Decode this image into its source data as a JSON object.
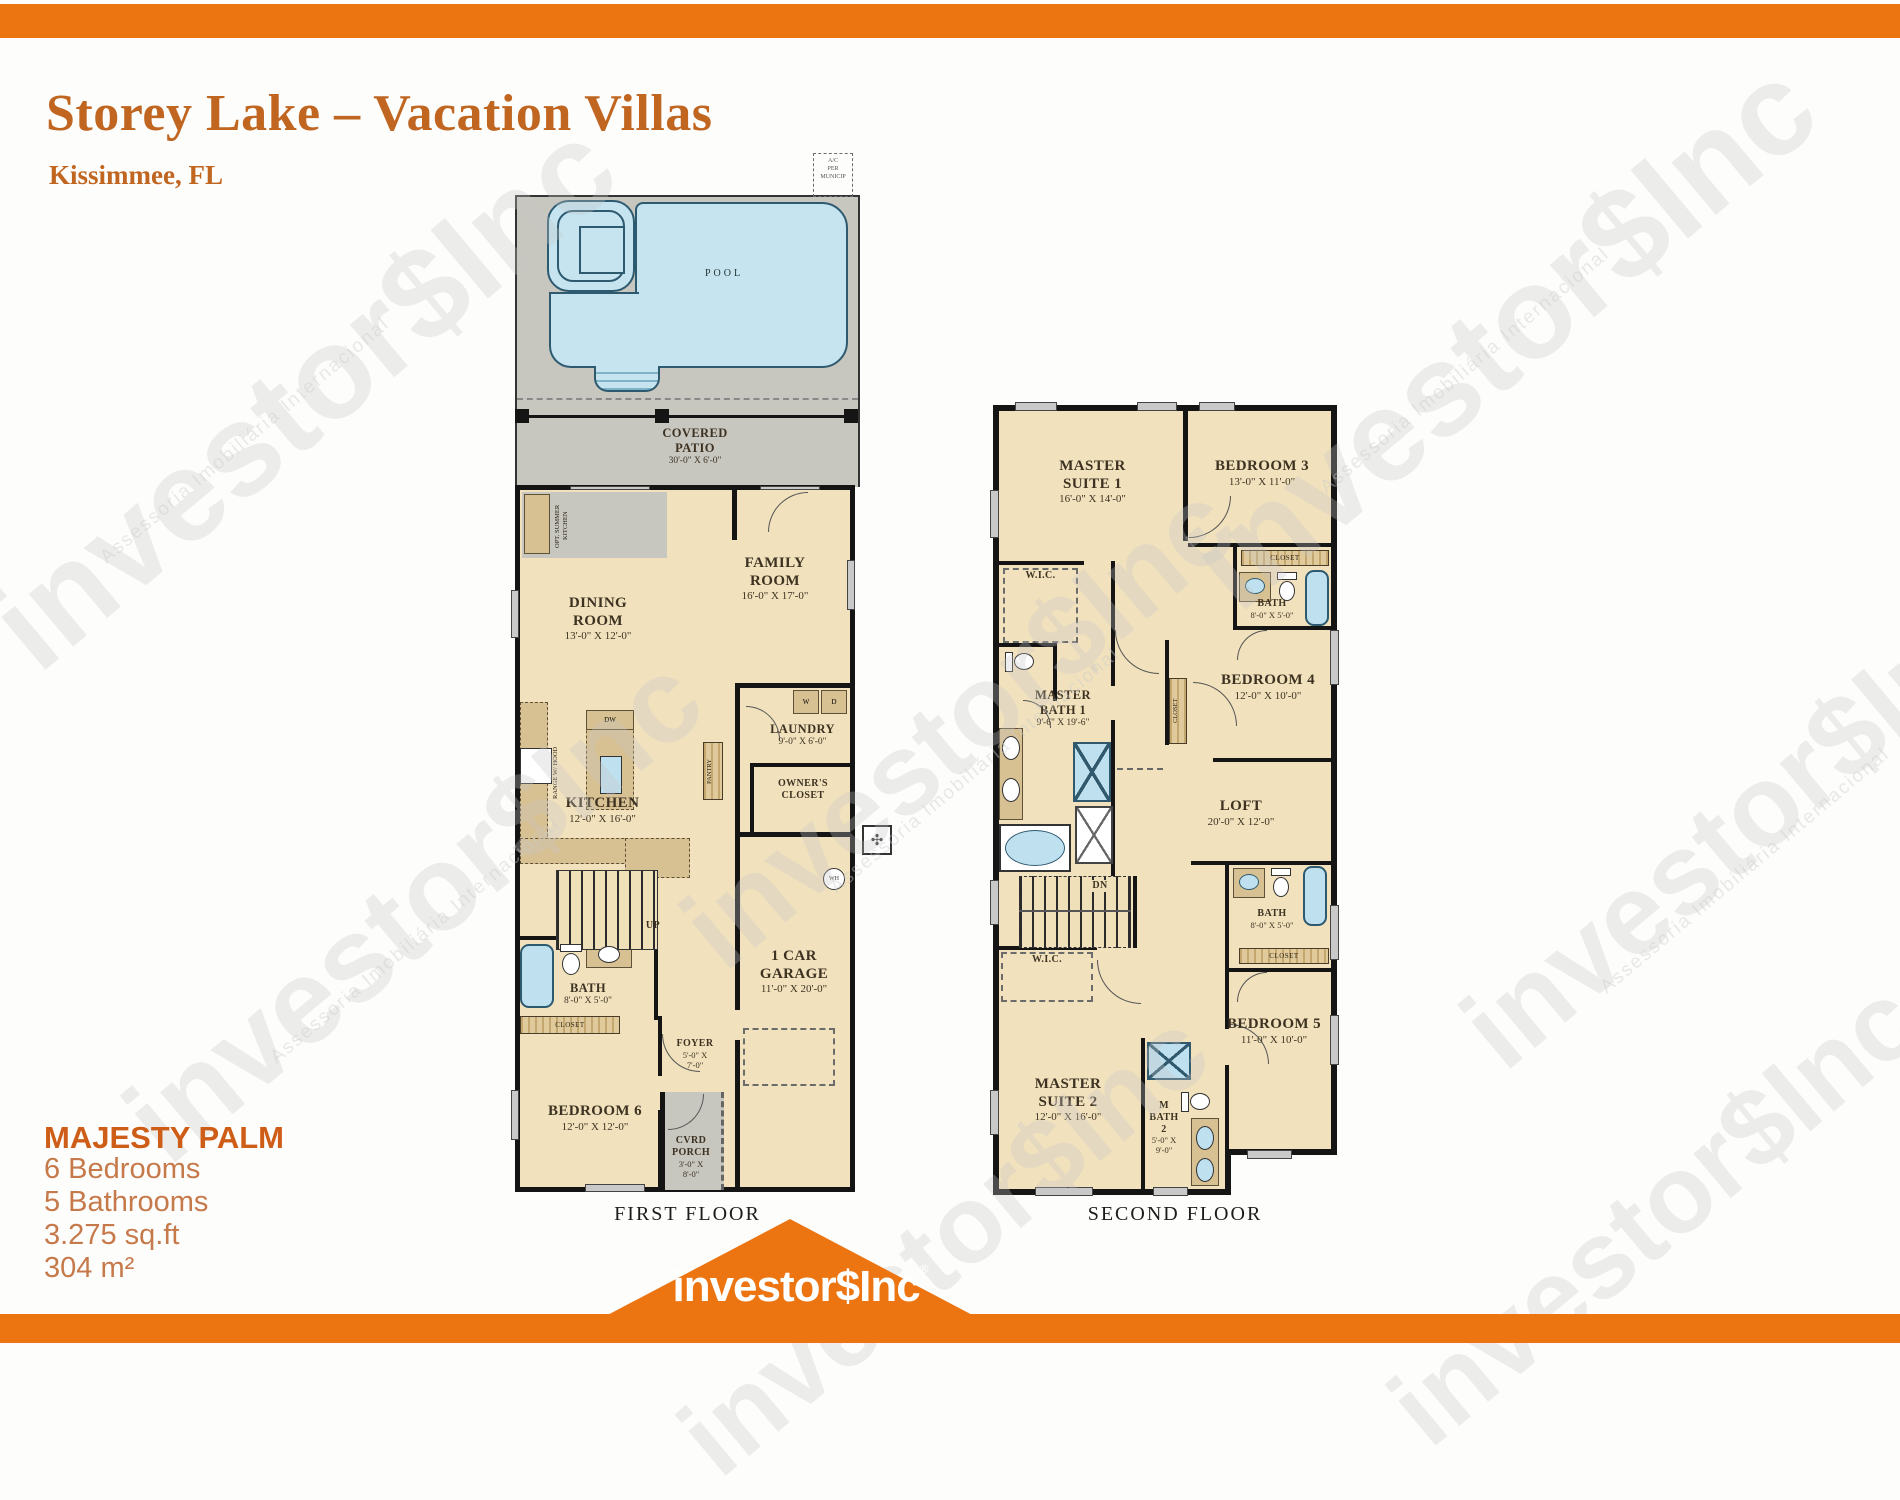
{
  "header": {
    "title": "Storey Lake – Vacation Villas",
    "subtitle": "Kissimmee, FL"
  },
  "property": {
    "name": "MAJESTY PALM",
    "bedrooms": "6 Bedrooms",
    "bathrooms": "5 Bathrooms",
    "area_imperial": "3.275 sq.ft",
    "area_metric": "304 m²"
  },
  "watermark": {
    "brand": "investor$Inc",
    "tagline": "Assessoria Imobiliária Internacional"
  },
  "footer": {
    "brand": "investor$Inc",
    "registered": "®"
  },
  "colors": {
    "accent_orange": "#EC7512",
    "title_orange": "#C06621",
    "info_orange": "#C67A4B",
    "room_beige": "#F1E2BD",
    "deck_gray": "#C7C6BF",
    "pool_blue": "#BFE0EE",
    "cabinet_tan": "#D7C092"
  },
  "floors": {
    "first": {
      "caption": "FIRST FLOOR",
      "outdoor": {
        "pool": "POOL",
        "equip_l1": "A/C",
        "equip_l2": "PER",
        "equip_l3": "MUNICIP",
        "patio_l1": "COVERED",
        "patio_l2": "PATIO",
        "patio_dims": "30'-0\" X 6'-0\"",
        "summer_kitchen": "OPT. SUMMER KITCHEN",
        "porch_l1": "CVRD",
        "porch_l2": "PORCH",
        "porch_d1": "3'-0\" X",
        "porch_d2": "8'-0\""
      },
      "rooms": {
        "family": {
          "l1": "FAMILY",
          "l2": "ROOM",
          "dims": "16'-0\" X 17'-0\""
        },
        "dining": {
          "l1": "DINING",
          "l2": "ROOM",
          "dims": "13'-0\" X 12'-0\""
        },
        "kitchen": {
          "l1": "KITCHEN",
          "dims": "12'-0\" X 16'-0\""
        },
        "laundry": {
          "l1": "LAUNDRY",
          "dims": "9'-0\" X 6'-0\""
        },
        "bath": {
          "l1": "BATH",
          "dims": "8'-0\" X 5'-0\""
        },
        "bedroom6": {
          "l1": "BEDROOM 6",
          "dims": "12'-0\" X 12'-0\""
        },
        "foyer": {
          "l1": "FOYER",
          "d1": "5'-0\" X",
          "d2": "7'-0\""
        },
        "garage": {
          "l1": "1 CAR",
          "l2": "GARAGE",
          "dims": "11'-0\" X 20'-0\""
        },
        "owners": {
          "l1": "OWNER'S",
          "l2": "CLOSET"
        }
      },
      "labels": {
        "washer": "W",
        "dryer": "D",
        "dishwasher": "DW",
        "pantry": "PANTRY",
        "range": "RANGE W/ HOOD",
        "up": "UP",
        "wh": "WH",
        "closet": "CLOSET"
      }
    },
    "second": {
      "caption": "SECOND FLOOR",
      "rooms": {
        "ms1": {
          "l1": "MASTER",
          "l2": "SUITE 1",
          "dims": "16'-0\" X 14'-0\""
        },
        "br3": {
          "l1": "BEDROOM 3",
          "dims": "13'-0\" X 11'-0\""
        },
        "bath_u": {
          "l1": "BATH",
          "dims": "8'-0\" X 5'-0\""
        },
        "mbath1": {
          "l1": "MASTER",
          "l2": "BATH 1",
          "dims": "9'-6\" X 19'-6\""
        },
        "br4": {
          "l1": "BEDROOM 4",
          "dims": "12'-0\" X 10'-0\""
        },
        "loft": {
          "l1": "LOFT",
          "dims": "20'-0\" X 12'-0\""
        },
        "bath_l": {
          "l1": "BATH",
          "dims": "8'-0\" X 5'-0\""
        },
        "br5": {
          "l1": "BEDROOM 5",
          "dims": "11'-0\" X 10'-0\""
        },
        "ms2": {
          "l1": "MASTER",
          "l2": "SUITE 2",
          "dims": "12'-0\" X 16'-0\""
        },
        "mbath2": {
          "l1": "M",
          "l2": "BATH",
          "l3": "2",
          "d1": "5'-0\" X",
          "d2": "9'-0\""
        }
      },
      "labels": {
        "wic": "W.I.C.",
        "closet": "CLOSET",
        "dn": "DN"
      }
    }
  }
}
